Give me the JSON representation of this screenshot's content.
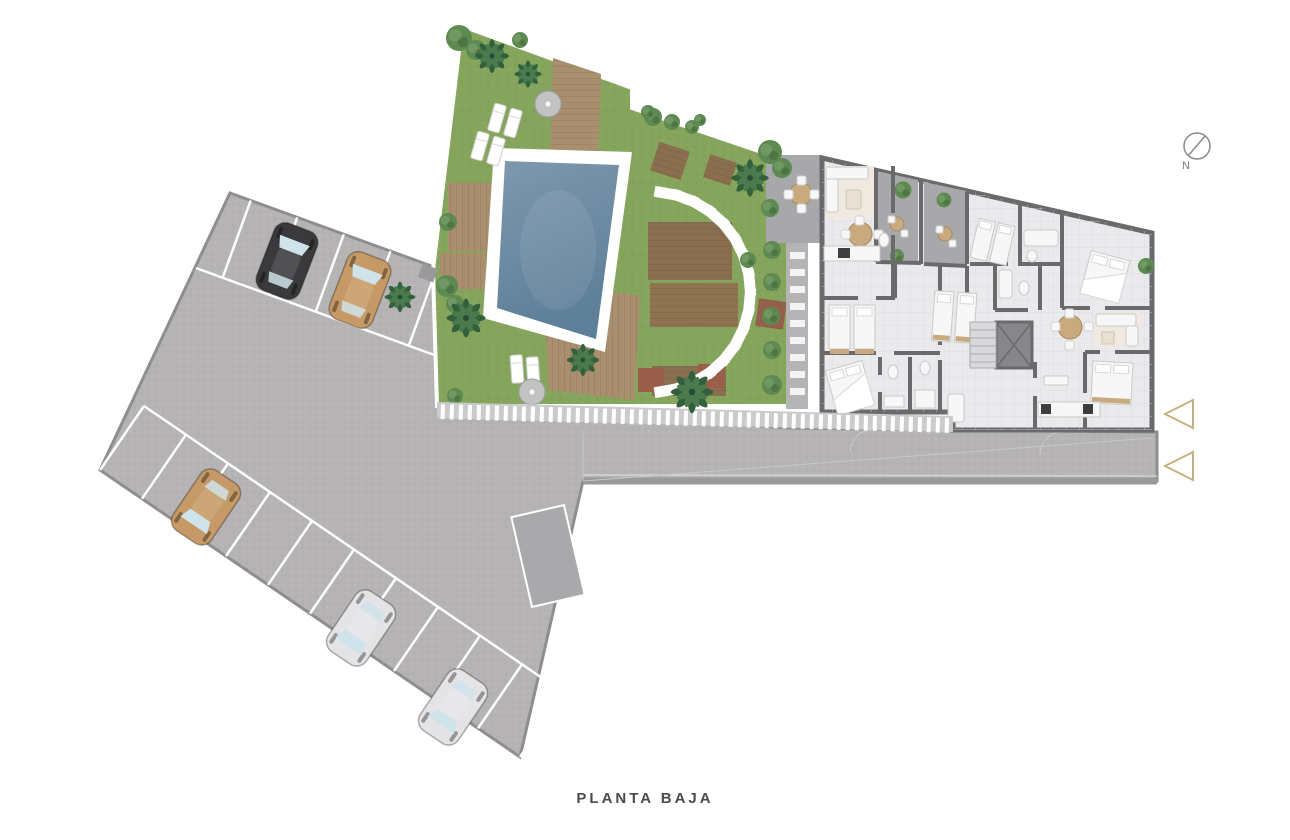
{
  "title": {
    "label": "PLANTA BAJA"
  },
  "compass": {
    "label": "N"
  },
  "palette": {
    "background": "#ffffff",
    "pavement": "#b5b3b4",
    "pavement_edge": "#8e8e90",
    "curb": "#9a989a",
    "lawn": "#85a55c",
    "lawn_dark": "#6f9450",
    "pool_water": "#7e98ae",
    "pool_water_deep": "#5d7f99",
    "pool_coping": "#ffffff",
    "deck_wood": "#a98f6e",
    "deck_wood_dark": "#8f7656",
    "platform_brown": "#8a6e4e",
    "platform_red": "#9a5f4a",
    "palm_green": "#33603c",
    "palm_green_light": "#4c7a4f",
    "bush_green": "#5d8a50",
    "bush_light": "#8fae6a",
    "wall": "#6a6a6c",
    "floor": "#eaeaec",
    "floor_grid": "#d9d9db",
    "terrace": "#a8a8aa",
    "furniture_white": "#f7f7f7",
    "furniture_tan": "#c9a97e",
    "rug_beige": "#efe9e0",
    "appliance_dark": "#3e3e40",
    "marker_gold": "#c7b183",
    "fence_base": "#cbcbcd",
    "car_black": "#3a3a3c",
    "car_tan": "#c69a66",
    "car_white": "#e4e4e6",
    "window_glass": "#cfe3ea",
    "text": "#4b4b4d"
  },
  "site": {
    "parking": {
      "rows": [
        {
          "name": "upper-row",
          "bays": 5
        },
        {
          "name": "lower-row",
          "bays": 10
        }
      ],
      "cars": [
        {
          "color_name": "black",
          "x": 287,
          "y": 261,
          "rotate": 21
        },
        {
          "color_name": "tan",
          "x": 360,
          "y": 290,
          "rotate": 21
        },
        {
          "color_name": "tan",
          "x": 206,
          "y": 507,
          "rotate": 214
        },
        {
          "color_name": "white",
          "x": 361,
          "y": 628,
          "rotate": 214
        },
        {
          "color_name": "white",
          "x": 453,
          "y": 707,
          "rotate": 214
        }
      ]
    },
    "garden": {
      "features": [
        "swimming-pool",
        "wood-decks",
        "palm-trees",
        "sun-loungers",
        "parasols",
        "stepping-stone-arc",
        "timber-platforms",
        "hedge",
        "planter",
        "perimeter-fence"
      ]
    },
    "building": {
      "features": [
        "apartments",
        "terraces",
        "bedrooms",
        "bathrooms",
        "kitchens",
        "living-rooms",
        "dining-tables",
        "elevator",
        "stairs"
      ]
    },
    "markers": {
      "entrance_triangles": 2
    }
  }
}
